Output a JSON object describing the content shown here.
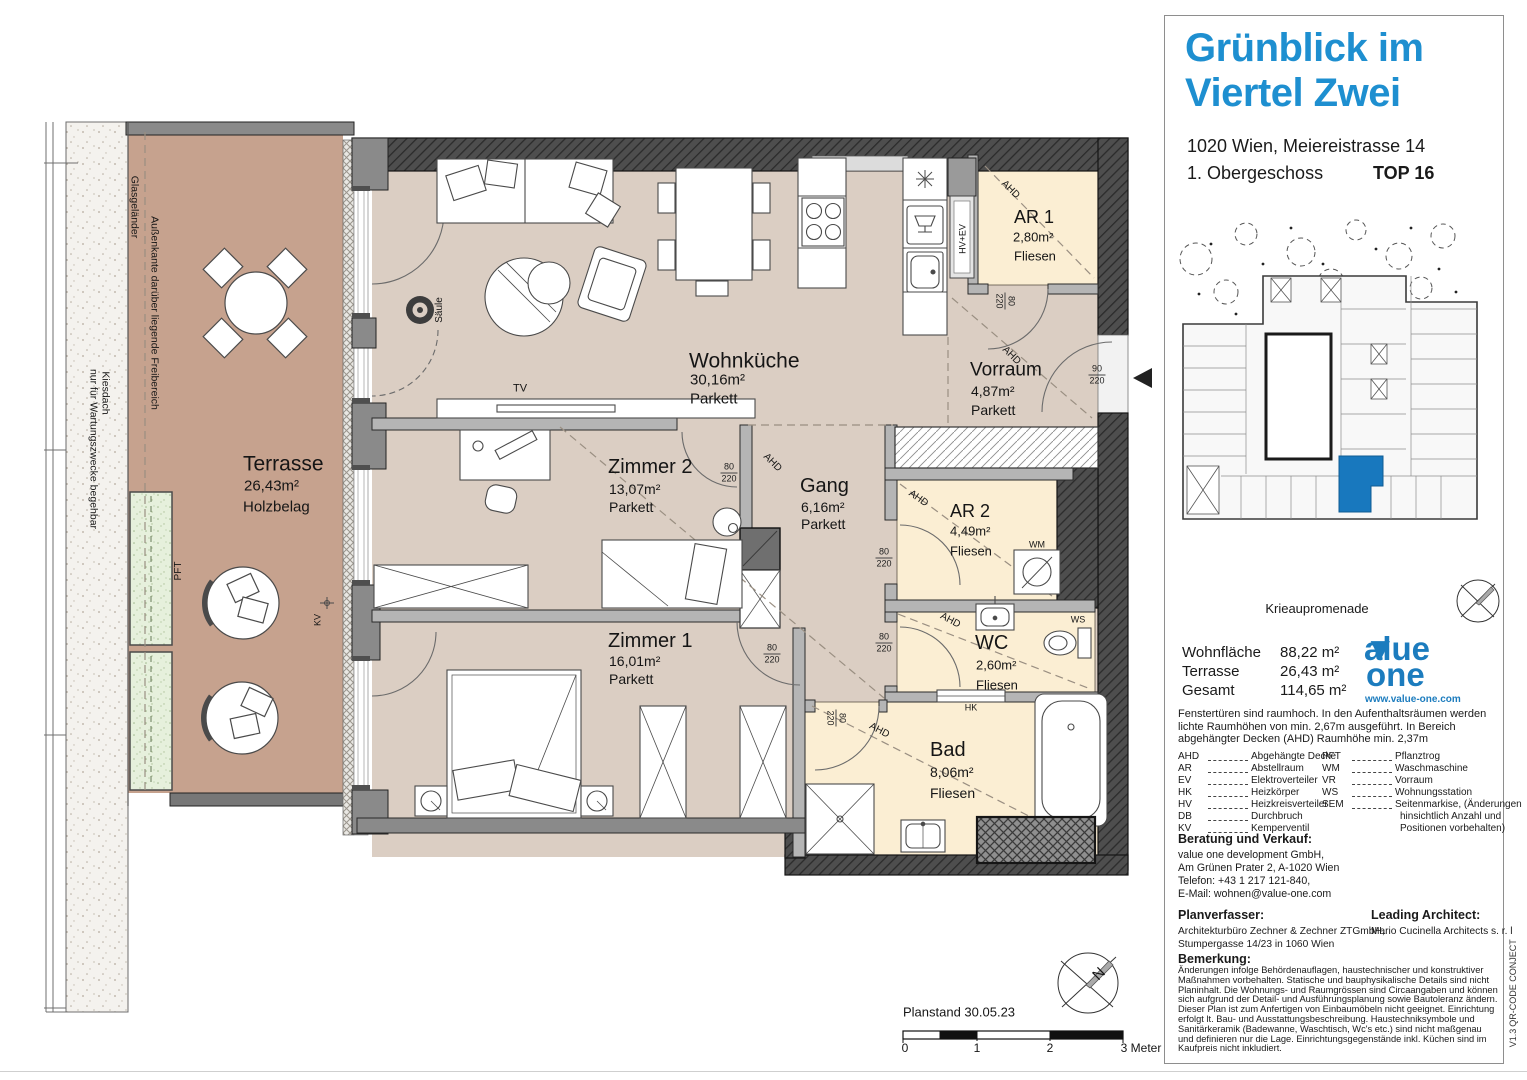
{
  "header": {
    "title_line1": "Grünblick im",
    "title_line2": "Viertel Zwei",
    "address": "1020 Wien, Meiereistrasse 14",
    "floor": "1. Obergeschoss",
    "unit": "TOP 16"
  },
  "site_plan": {
    "street_label": "Meiereistraße"
  },
  "sidebar": {
    "promenade_label": "Krieaupromenade",
    "areas": {
      "rows": [
        {
          "label": "Wohnfläche",
          "value": "88,22 m²"
        },
        {
          "label": "Terrasse",
          "value": "26,43 m²"
        },
        {
          "label": "Gesamt",
          "value": "114,65 m²"
        }
      ]
    },
    "logo": {
      "word1": "value",
      "word2": "one",
      "url": "www.value-one.com",
      "color": "#1c7cbe"
    },
    "ceiling_note": "Fenstertüren sind raumhoch. In den Aufenthaltsräumen werden lichte Raumhöhen von min. 2,67m ausgeführt. In Bereich abgehängter Decken (AHD) Raumhöhe min. 2,37m",
    "legend": {
      "col1": [
        {
          "abbr": "AHD",
          "desc": "Abgehängte Decke"
        },
        {
          "abbr": "AR",
          "desc": "Abstellraum"
        },
        {
          "abbr": "EV",
          "desc": "Elektroverteiler"
        },
        {
          "abbr": "HK",
          "desc": "Heizkörper"
        },
        {
          "abbr": "HV",
          "desc": "Heizkreisverteiler"
        },
        {
          "abbr": "DB",
          "desc": "Durchbruch"
        },
        {
          "abbr": "KV",
          "desc": "Kemperventil"
        }
      ],
      "col2": [
        {
          "abbr": "PFT",
          "desc": "Pflanztrog"
        },
        {
          "abbr": "WM",
          "desc": "Waschmaschine"
        },
        {
          "abbr": "VR",
          "desc": "Vorraum"
        },
        {
          "abbr": "WS",
          "desc": "Wohnungsstation"
        },
        {
          "abbr": "SEM",
          "desc": "Seitenmarkise, (Änderungen"
        }
      ],
      "col2_extra": [
        "hinsichtlich Anzahl und",
        "Positionen vorbehalten)"
      ]
    },
    "contact": {
      "heading": "Beratung und Verkauf:",
      "lines": [
        "value one development GmbH,",
        "Am Grünen Prater 2, A-1020 Wien",
        "Telefon: +43 1 217 121-840,",
        "E-Mail: wohnen@value-one.com"
      ]
    },
    "planner": {
      "heading": "Planverfasser:",
      "lines": [
        "Architekturbüro Zechner & Zechner ZTGmbH,",
        "Stumpergasse 14/23 in 1060 Wien"
      ]
    },
    "architect": {
      "heading": "Leading Architect:",
      "lines": [
        "Mario Cucinella Architects s. r. l"
      ]
    },
    "remark": {
      "heading": "Bemerkung:",
      "text": "Änderungen infolge Behördenauflagen, haustechnischer und konstruktiver Maßnahmen vorbehalten. Statische und bauphysikalische Details sind nicht Planinhalt. Die Wohnungs- und Raumgrössen sind Circaangaben und können sich aufgrund der Detail- und Ausführungsplanung sowie Bautoleranz ändern. Dieser Plan ist zum Anfertigen von Einbaumöbeln nicht geeignet. Einrichtung erfolgt lt. Bau- und Ausstattungsbeschreibung. Haustechniksymbole und Sanitärkeramik (Badewanne, Waschtisch, Wc's etc.) sind nicht maßgenau und definieren nur die Lage. Einrichtungsgegenstände inkl. Küchen sind im Kaufpreis nicht inkludiert."
    },
    "margin": {
      "qr": "QR-CODE CONJECT",
      "version": "V1.3"
    }
  },
  "plan": {
    "annotations": [
      {
        "id": "room-terrasse-name",
        "t": "Terrasse",
        "x": 243,
        "y": 464,
        "s": 21,
        "a": "l"
      },
      {
        "id": "room-terrasse-area",
        "t": "26,43m²",
        "x": 244,
        "y": 486,
        "s": 15,
        "a": "l"
      },
      {
        "id": "room-terrasse-floor",
        "t": "Holzbelag",
        "x": 243,
        "y": 507,
        "s": 15,
        "a": "l"
      },
      {
        "id": "room-wohnkueche-name",
        "t": "Wohnküche",
        "x": 689,
        "y": 361,
        "s": 21,
        "a": "l"
      },
      {
        "id": "room-wohnkueche-area",
        "t": "30,16m²",
        "x": 690,
        "y": 380,
        "s": 15,
        "a": "l"
      },
      {
        "id": "room-wohnkueche-floor",
        "t": "Parkett",
        "x": 690,
        "y": 399,
        "s": 15,
        "a": "l"
      },
      {
        "id": "room-vorraum-name",
        "t": "Vorraum",
        "x": 970,
        "y": 370,
        "s": 19,
        "a": "l"
      },
      {
        "id": "room-vorraum-area",
        "t": "4,87m²",
        "x": 971,
        "y": 391,
        "s": 14,
        "a": "l"
      },
      {
        "id": "room-vorraum-floor",
        "t": "Parkett",
        "x": 971,
        "y": 410,
        "s": 14,
        "a": "l"
      },
      {
        "id": "room-ar1-name",
        "t": "AR 1",
        "x": 1014,
        "y": 217,
        "s": 18,
        "a": "l"
      },
      {
        "id": "room-ar1-area",
        "t": "2,80m²",
        "x": 1013,
        "y": 237,
        "s": 13,
        "a": "l"
      },
      {
        "id": "room-ar1-floor",
        "t": "Fliesen",
        "x": 1014,
        "y": 256,
        "s": 13,
        "a": "l"
      },
      {
        "id": "room-zimmer2-name",
        "t": "Zimmer 2",
        "x": 608,
        "y": 467,
        "s": 20,
        "a": "l"
      },
      {
        "id": "room-zimmer2-area",
        "t": "13,07m²",
        "x": 609,
        "y": 489,
        "s": 14,
        "a": "l"
      },
      {
        "id": "room-zimmer2-floor",
        "t": "Parkett",
        "x": 609,
        "y": 507,
        "s": 14,
        "a": "l"
      },
      {
        "id": "room-gang-name",
        "t": "Gang",
        "x": 800,
        "y": 486,
        "s": 20,
        "a": "l"
      },
      {
        "id": "room-gang-area",
        "t": "6,16m²",
        "x": 801,
        "y": 507,
        "s": 14,
        "a": "l"
      },
      {
        "id": "room-gang-floor",
        "t": "Parkett",
        "x": 801,
        "y": 524,
        "s": 14,
        "a": "l"
      },
      {
        "id": "room-ar2-name",
        "t": "AR 2",
        "x": 950,
        "y": 511,
        "s": 18,
        "a": "l"
      },
      {
        "id": "room-ar2-area",
        "t": "4,49m²",
        "x": 950,
        "y": 531,
        "s": 13,
        "a": "l"
      },
      {
        "id": "room-ar2-floor",
        "t": "Fliesen",
        "x": 950,
        "y": 551,
        "s": 13,
        "a": "l"
      },
      {
        "id": "room-wc-name",
        "t": "WC",
        "x": 975,
        "y": 643,
        "s": 20,
        "a": "l"
      },
      {
        "id": "room-wc-area",
        "t": "2,60m²",
        "x": 976,
        "y": 665,
        "s": 13,
        "a": "l"
      },
      {
        "id": "room-wc-floor",
        "t": "Fliesen",
        "x": 976,
        "y": 685,
        "s": 13,
        "a": "l"
      },
      {
        "id": "room-zimmer1-name",
        "t": "Zimmer 1",
        "x": 608,
        "y": 641,
        "s": 20,
        "a": "l"
      },
      {
        "id": "room-zimmer1-area",
        "t": "16,01m²",
        "x": 609,
        "y": 661,
        "s": 14,
        "a": "l"
      },
      {
        "id": "room-zimmer1-floor",
        "t": "Parkett",
        "x": 609,
        "y": 679,
        "s": 14,
        "a": "l"
      },
      {
        "id": "room-bad-name",
        "t": "Bad",
        "x": 930,
        "y": 750,
        "s": 20,
        "a": "l"
      },
      {
        "id": "room-bad-area",
        "t": "8,06m²",
        "x": 930,
        "y": 772,
        "s": 14,
        "a": "l"
      },
      {
        "id": "room-bad-floor",
        "t": "Fliesen",
        "x": 930,
        "y": 793,
        "s": 14,
        "a": "l"
      },
      {
        "id": "tv-label",
        "t": "TV",
        "x": 520,
        "y": 389,
        "s": 11
      },
      {
        "id": "saeule-label",
        "t": "Säule",
        "x": 440,
        "y": 310,
        "r": -90,
        "s": 10
      },
      {
        "id": "wm-label",
        "t": "WM",
        "x": 1037,
        "y": 545,
        "s": 9
      },
      {
        "id": "ws-label",
        "t": "WS",
        "x": 1078,
        "y": 620,
        "s": 9
      },
      {
        "id": "hk-label",
        "t": "HK",
        "x": 971,
        "y": 708,
        "s": 9
      },
      {
        "id": "kv-label",
        "t": "KV",
        "x": 318,
        "y": 620,
        "r": -90,
        "s": 9
      },
      {
        "id": "pft-label",
        "t": "PFT",
        "x": 179,
        "y": 571,
        "r": -90,
        "s": 10
      },
      {
        "id": "hvev-label",
        "t": "HV+EV",
        "x": 963,
        "y": 239,
        "r": -90,
        "s": 9
      },
      {
        "id": "ahd-ar1",
        "t": "AHD",
        "x": 1010,
        "y": 190,
        "r": 45,
        "s": 10
      },
      {
        "id": "ahd-vorraum",
        "t": "AHD",
        "x": 1011,
        "y": 356,
        "r": 45,
        "s": 10
      },
      {
        "id": "ahd-gang",
        "t": "AHD",
        "x": 772,
        "y": 463,
        "r": 45,
        "s": 10
      },
      {
        "id": "ahd-ar2",
        "t": "AHD",
        "x": 918,
        "y": 499,
        "r": 35,
        "s": 10
      },
      {
        "id": "ahd-wc",
        "t": "AHD",
        "x": 950,
        "y": 621,
        "r": 28,
        "s": 10
      },
      {
        "id": "ahd-bad",
        "t": "AHD",
        "x": 879,
        "y": 731,
        "r": 28,
        "s": 10
      },
      {
        "id": "glasgelaender-label",
        "t": "Glasgeländer",
        "x": 134,
        "y": 207,
        "r": 90,
        "s": 10.5
      },
      {
        "id": "aussenkante-label",
        "t": "Außenkante darüber liegende Freibereich",
        "x": 154,
        "y": 313,
        "r": 90,
        "s": 10.5
      },
      {
        "id": "kiesdach-label-1",
        "t": "Kiesdach",
        "x": 105,
        "y": 393,
        "r": 90,
        "s": 10.5
      },
      {
        "id": "kiesdach-label-2",
        "t": "nur für Wartungszwecke begehbar",
        "x": 93,
        "y": 449,
        "r": 90,
        "s": 10.5
      },
      {
        "id": "planstand-label",
        "t": "Planstand 30.05.23",
        "x": 903,
        "y": 1012,
        "s": 13,
        "a": "l"
      },
      {
        "id": "scale-tick-0",
        "t": "0",
        "x": 905,
        "y": 1048,
        "s": 12
      },
      {
        "id": "scale-tick-1",
        "t": "1",
        "x": 977,
        "y": 1048,
        "s": 12
      },
      {
        "id": "scale-tick-2",
        "t": "2",
        "x": 1050,
        "y": 1048,
        "s": 12
      },
      {
        "id": "scale-tick-3",
        "t": "3 Meter",
        "x": 1141,
        "y": 1048,
        "s": 12
      },
      {
        "id": "compass-n-plan",
        "t": "N",
        "x": 1099,
        "y": 974,
        "r": -45,
        "s": 15
      },
      {
        "id": "compass-n-sidebar",
        "t": "N",
        "x": 1487,
        "y": 597,
        "r": -45,
        "s": 10
      },
      {
        "id": "meiereistrasse-label",
        "t": "Meiereistraße",
        "x": 1491,
        "y": 258,
        "r": -90,
        "s": 10.5
      }
    ],
    "dims": [
      {
        "top": "80",
        "bottom": "220",
        "x": 729,
        "y": 473
      },
      {
        "top": "80",
        "bottom": "220",
        "x": 772,
        "y": 654
      },
      {
        "top": "80",
        "bottom": "220",
        "x": 884,
        "y": 558
      },
      {
        "top": "80",
        "bottom": "220",
        "x": 884,
        "y": 643
      },
      {
        "top": "80",
        "bottom": "220",
        "x": 836,
        "y": 718,
        "r": 90
      },
      {
        "top": "80",
        "bottom": "220",
        "x": 1005,
        "y": 301,
        "r": 90
      },
      {
        "top": "90",
        "bottom": "220",
        "x": 1097,
        "y": 375
      }
    ]
  }
}
